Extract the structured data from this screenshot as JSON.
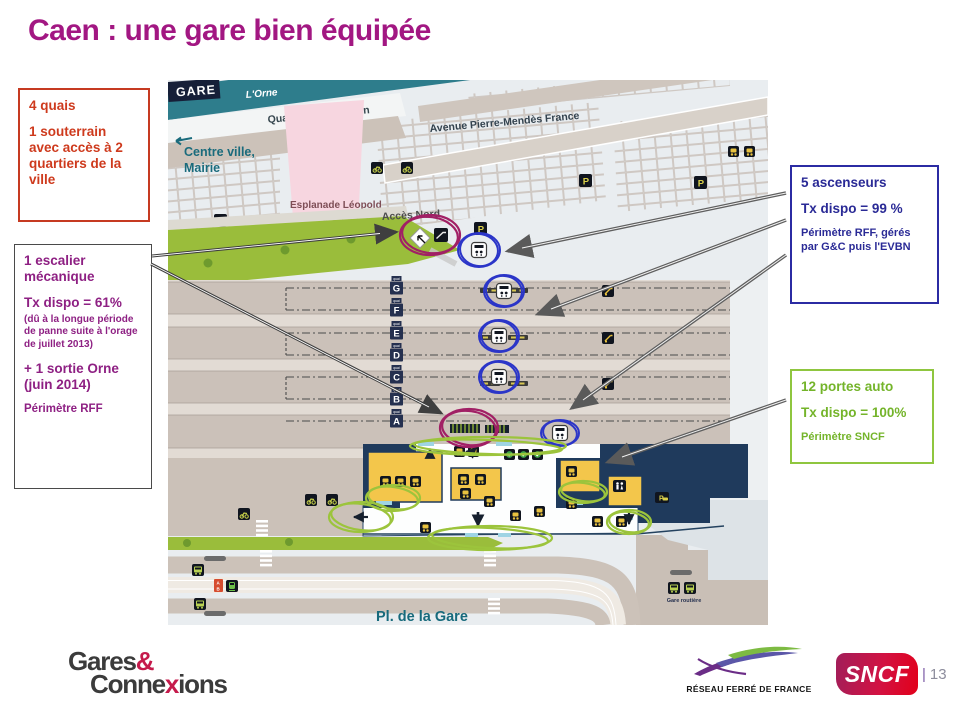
{
  "slide": {
    "title": "Caen :  une gare bien équipée",
    "page_sep": "|",
    "page_number": "13"
  },
  "callout_quais": {
    "l1": "4 quais",
    "l2": "1 souterrain avec accès à 2 quartiers de la ville"
  },
  "callout_escalier": {
    "l1": "1 escalier mécanique",
    "l2": "Tx dispo = 61%",
    "note": "(dû à la longue période de panne suite à l'orage de juillet 2013)",
    "l3": "+ 1 sortie Orne (juin 2014)",
    "l4": "Périmètre RFF"
  },
  "callout_ascenseurs": {
    "l1": "5 ascenseurs",
    "l2": "Tx dispo = 99 %",
    "note": "Périmètre RFF, gérés par G&C puis l'EVBN"
  },
  "callout_portes": {
    "l1": "12 portes auto",
    "l2": "Tx dispo = 100%",
    "note": "Périmètre SNCF"
  },
  "map": {
    "gare_label": "GARE",
    "river": "L'Orne",
    "quai_street": "Quai Amiral Hamelin",
    "centre_ville": "Centre ville,",
    "mairie": "Mairie",
    "esplanade1": "Esplanade Léopold",
    "esplanade2": "Sédar Senghor",
    "avenue": "Avenue Pierre-Mendès France",
    "acces_nord": "Accès Nord",
    "place": "Pl. de la Gare",
    "gare_routiere": "Gare routière",
    "quai_tag": "quai",
    "parking_letter": "P",
    "tram_a": "A",
    "tram_b": "B",
    "platforms": [
      "G",
      "F",
      "E",
      "D",
      "C",
      "B",
      "A"
    ]
  },
  "footer": {
    "gares": "Gares",
    "amp": "&",
    "connexions_pre": "Conne",
    "connexions_x": "x",
    "connexions_post": "ions",
    "rff": "RÉSEAU FERRÉ DE FRANCE",
    "sncf": "SNCF"
  },
  "colors": {
    "title": "#A21782",
    "quais_accent": "#CE3A1D",
    "escalier_accent": "#8E2083",
    "ascenseurs_accent": "#2A2A96",
    "portes_accent": "#74B42A",
    "river_teal": "#2E7D8C",
    "building_navy": "#1F3A5C",
    "grass_green": "#9ABD3B",
    "sncf_red": "#E2001A"
  }
}
